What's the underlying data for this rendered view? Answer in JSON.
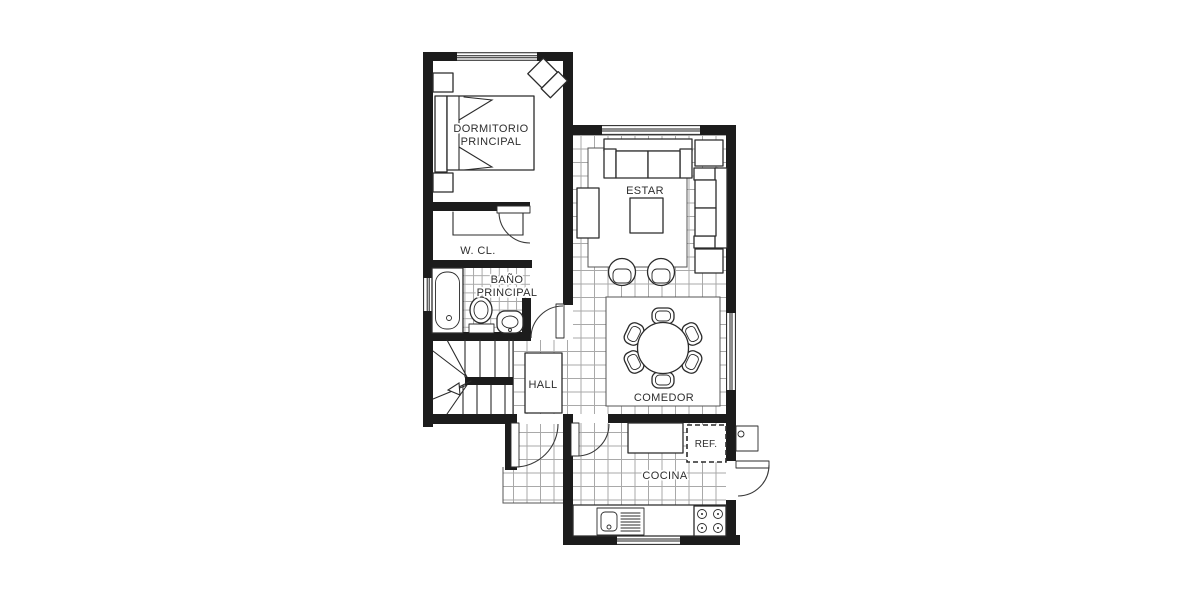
{
  "plan": {
    "background": "#ffffff",
    "colors": {
      "wall": "#1c1c1c",
      "tile": "#a9a9a9",
      "outline": "#2b2b2b",
      "text": "#2e2e2e",
      "background": "#ffffff"
    },
    "rooms": {
      "dormitorio_line1": "DORMITORIO",
      "dormitorio_line2": "PRINCIPAL",
      "wcl": "W. CL.",
      "bano_line1": "BAÑO",
      "bano_line2": "PRINCIPAL",
      "hall": "HALL",
      "estar": "ESTAR",
      "comedor": "COMEDOR",
      "cocina": "COCINA",
      "ref": "REF."
    }
  }
}
